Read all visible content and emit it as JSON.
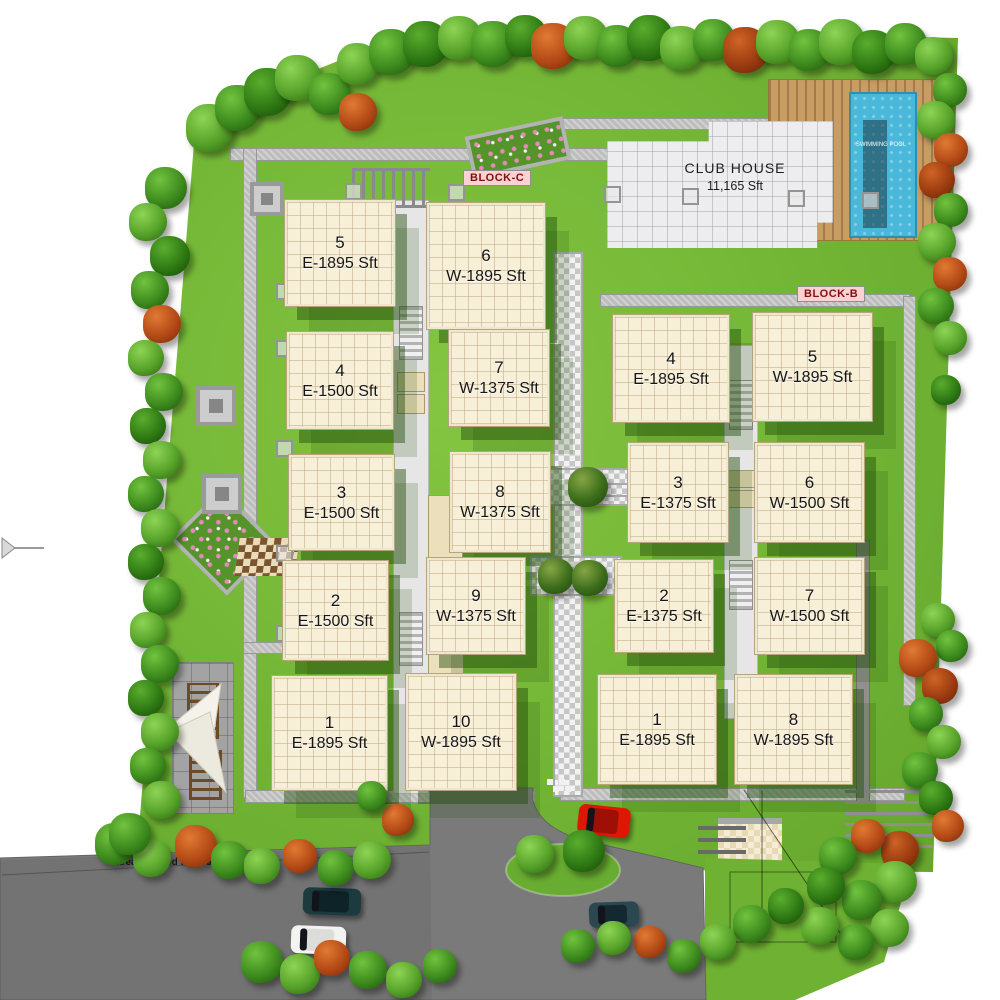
{
  "site": {
    "block_c_label": "BLOCK-C",
    "block_b_label": "BLOCK-B",
    "club_house": {
      "name": "CLUB HOUSE",
      "area": "11,165 Sft"
    },
    "pool_label": "SWIMMING POOL",
    "road_note": "area affected for road widening"
  },
  "blocks": {
    "c": {
      "label": "BLOCK-C",
      "units": [
        {
          "num": "5",
          "area": "E-1895 Sft",
          "x": 285,
          "y": 200,
          "w": 106,
          "h": 102
        },
        {
          "num": "6",
          "area": "W-1895 Sft",
          "x": 427,
          "y": 203,
          "w": 114,
          "h": 122
        },
        {
          "num": "4",
          "area": "E-1500 Sft",
          "x": 287,
          "y": 332,
          "w": 102,
          "h": 93
        },
        {
          "num": "7",
          "area": "W-1375 Sft",
          "x": 449,
          "y": 330,
          "w": 96,
          "h": 92
        },
        {
          "num": "3",
          "area": "E-1500 Sft",
          "x": 289,
          "y": 455,
          "w": 101,
          "h": 91
        },
        {
          "num": "8",
          "area": "W-1375 Sft",
          "x": 450,
          "y": 452,
          "w": 96,
          "h": 96
        },
        {
          "num": "2",
          "area": "E-1500 Sft",
          "x": 283,
          "y": 561,
          "w": 101,
          "h": 95
        },
        {
          "num": "9",
          "area": "W-1375 Sft",
          "x": 427,
          "y": 558,
          "w": 94,
          "h": 92
        },
        {
          "num": "1",
          "area": "E-1895 Sft",
          "x": 272,
          "y": 676,
          "w": 111,
          "h": 110
        },
        {
          "num": "10",
          "area": "W-1895 Sft",
          "x": 406,
          "y": 674,
          "w": 106,
          "h": 112
        }
      ]
    },
    "b": {
      "label": "BLOCK-B",
      "units": [
        {
          "num": "4",
          "area": "E-1895 Sft",
          "x": 613,
          "y": 315,
          "w": 112,
          "h": 103
        },
        {
          "num": "5",
          "area": "W-1895 Sft",
          "x": 753,
          "y": 313,
          "w": 115,
          "h": 104
        },
        {
          "num": "3",
          "area": "E-1375 Sft",
          "x": 628,
          "y": 443,
          "w": 96,
          "h": 95
        },
        {
          "num": "6",
          "area": "W-1500 Sft",
          "x": 755,
          "y": 443,
          "w": 105,
          "h": 95
        },
        {
          "num": "2",
          "area": "E-1375 Sft",
          "x": 615,
          "y": 560,
          "w": 94,
          "h": 88
        },
        {
          "num": "7",
          "area": "W-1500 Sft",
          "x": 755,
          "y": 558,
          "w": 105,
          "h": 92
        },
        {
          "num": "1",
          "area": "E-1895 Sft",
          "x": 598,
          "y": 675,
          "w": 114,
          "h": 105
        },
        {
          "num": "8",
          "area": "W-1895 Sft",
          "x": 735,
          "y": 675,
          "w": 113,
          "h": 105
        }
      ]
    }
  },
  "colors": {
    "lawn": "#6fb233",
    "lawn_dark": "#2f6b12",
    "road": "#7a7a7a",
    "building": "#f7efd8",
    "club": "#ededef",
    "pool": "#49b8da",
    "deck": "#c79d64",
    "badge_bg": "#fbd2d2",
    "badge_text": "#801010",
    "path": "#bdbdbd"
  },
  "decor": {
    "trees": [
      [
        210,
        128,
        24,
        1
      ],
      [
        238,
        108,
        23,
        0
      ],
      [
        268,
        92,
        24,
        2
      ],
      [
        298,
        78,
        23,
        1
      ],
      [
        330,
        94,
        21,
        0
      ],
      [
        358,
        112,
        19,
        3
      ],
      [
        358,
        64,
        21,
        1
      ],
      [
        392,
        52,
        23,
        0
      ],
      [
        426,
        44,
        23,
        2
      ],
      [
        460,
        38,
        22,
        1
      ],
      [
        494,
        44,
        23,
        0
      ],
      [
        526,
        36,
        21,
        2
      ],
      [
        554,
        46,
        23,
        3
      ],
      [
        586,
        38,
        22,
        1
      ],
      [
        618,
        46,
        21,
        0
      ],
      [
        650,
        38,
        23,
        2
      ],
      [
        682,
        48,
        22,
        1
      ],
      [
        714,
        40,
        21,
        0
      ],
      [
        746,
        50,
        23,
        4
      ],
      [
        778,
        42,
        22,
        1
      ],
      [
        810,
        50,
        21,
        0
      ],
      [
        842,
        42,
        23,
        1
      ],
      [
        874,
        52,
        22,
        2
      ],
      [
        906,
        44,
        21,
        0
      ],
      [
        934,
        56,
        19,
        1
      ],
      [
        950,
        90,
        17,
        0
      ],
      [
        936,
        120,
        19,
        1
      ],
      [
        951,
        150,
        17,
        3
      ],
      [
        937,
        180,
        18,
        4
      ],
      [
        951,
        210,
        17,
        0
      ],
      [
        937,
        242,
        19,
        1
      ],
      [
        950,
        274,
        17,
        3
      ],
      [
        936,
        306,
        18,
        0
      ],
      [
        950,
        338,
        17,
        1
      ],
      [
        946,
        390,
        15,
        2
      ],
      [
        938,
        620,
        17,
        1
      ],
      [
        952,
        646,
        16,
        0
      ],
      [
        918,
        658,
        19,
        3
      ],
      [
        940,
        686,
        18,
        4
      ],
      [
        926,
        714,
        17,
        0
      ],
      [
        944,
        742,
        17,
        1
      ],
      [
        920,
        770,
        18,
        0
      ],
      [
        936,
        798,
        17,
        2
      ],
      [
        948,
        826,
        16,
        3
      ],
      [
        900,
        850,
        19,
        4
      ],
      [
        868,
        836,
        17,
        3
      ],
      [
        838,
        856,
        19,
        0
      ],
      [
        896,
        882,
        21,
        1
      ],
      [
        862,
        900,
        20,
        0
      ],
      [
        826,
        886,
        19,
        2
      ],
      [
        890,
        928,
        19,
        1
      ],
      [
        856,
        942,
        18,
        0
      ],
      [
        820,
        926,
        19,
        1
      ],
      [
        786,
        906,
        18,
        2
      ],
      [
        752,
        924,
        19,
        0
      ],
      [
        718,
        942,
        18,
        1
      ],
      [
        684,
        956,
        17,
        0
      ],
      [
        650,
        942,
        16,
        3
      ],
      [
        614,
        938,
        17,
        1
      ],
      [
        578,
        946,
        17,
        0
      ],
      [
        116,
        844,
        21,
        0
      ],
      [
        152,
        858,
        19,
        1
      ],
      [
        196,
        846,
        21,
        3
      ],
      [
        230,
        860,
        19,
        0
      ],
      [
        262,
        866,
        18,
        1
      ],
      [
        300,
        856,
        17,
        3
      ],
      [
        336,
        868,
        18,
        0
      ],
      [
        372,
        860,
        19,
        1
      ],
      [
        398,
        820,
        16,
        3
      ],
      [
        372,
        796,
        15,
        0
      ],
      [
        262,
        962,
        21,
        0
      ],
      [
        300,
        974,
        20,
        1
      ],
      [
        332,
        958,
        18,
        3
      ],
      [
        368,
        970,
        19,
        0
      ],
      [
        404,
        980,
        18,
        1
      ],
      [
        440,
        966,
        17,
        0
      ],
      [
        166,
        188,
        21,
        0
      ],
      [
        148,
        222,
        19,
        1
      ],
      [
        170,
        256,
        20,
        2
      ],
      [
        150,
        290,
        19,
        0
      ],
      [
        162,
        324,
        19,
        3
      ],
      [
        146,
        358,
        18,
        1
      ],
      [
        164,
        392,
        19,
        0
      ],
      [
        148,
        426,
        18,
        2
      ],
      [
        162,
        460,
        19,
        1
      ],
      [
        146,
        494,
        18,
        0
      ],
      [
        160,
        528,
        19,
        1
      ],
      [
        146,
        562,
        18,
        2
      ],
      [
        162,
        596,
        19,
        0
      ],
      [
        148,
        630,
        18,
        1
      ],
      [
        160,
        664,
        19,
        0
      ],
      [
        146,
        698,
        18,
        2
      ],
      [
        160,
        732,
        19,
        1
      ],
      [
        148,
        766,
        18,
        0
      ],
      [
        162,
        800,
        19,
        1
      ],
      [
        130,
        834,
        21,
        0
      ],
      [
        588,
        487,
        20,
        5
      ],
      [
        556,
        576,
        18,
        5
      ],
      [
        590,
        578,
        18,
        5
      ],
      [
        535,
        854,
        19,
        1
      ],
      [
        584,
        851,
        21,
        2
      ]
    ],
    "cars": [
      {
        "x": 578,
        "y": 806,
        "w": 52,
        "h": 30,
        "body": "#dd1605",
        "roof": "#9e1005",
        "rot": 6
      },
      {
        "x": 303,
        "y": 888,
        "w": 58,
        "h": 27,
        "body": "#1c3b3f",
        "roof": "#0d2327",
        "rot": 2
      },
      {
        "x": 291,
        "y": 926,
        "w": 55,
        "h": 28,
        "body": "#f3f3f1",
        "roof": "#dcdcda",
        "rot": 2
      },
      {
        "x": 589,
        "y": 902,
        "w": 50,
        "h": 25,
        "body": "#2b4850",
        "roof": "#142830",
        "rot": -2
      }
    ],
    "path_squares": [
      [
        345,
        183
      ],
      [
        448,
        184
      ],
      [
        604,
        186
      ],
      [
        682,
        188
      ],
      [
        788,
        190
      ],
      [
        862,
        192
      ],
      [
        276,
        283
      ],
      [
        276,
        340
      ],
      [
        276,
        440
      ],
      [
        276,
        545
      ],
      [
        276,
        625
      ],
      [
        297,
        690
      ]
    ],
    "pavilions": [
      [
        250,
        182,
        26
      ],
      [
        196,
        386,
        32
      ],
      [
        202,
        474,
        32
      ]
    ]
  }
}
